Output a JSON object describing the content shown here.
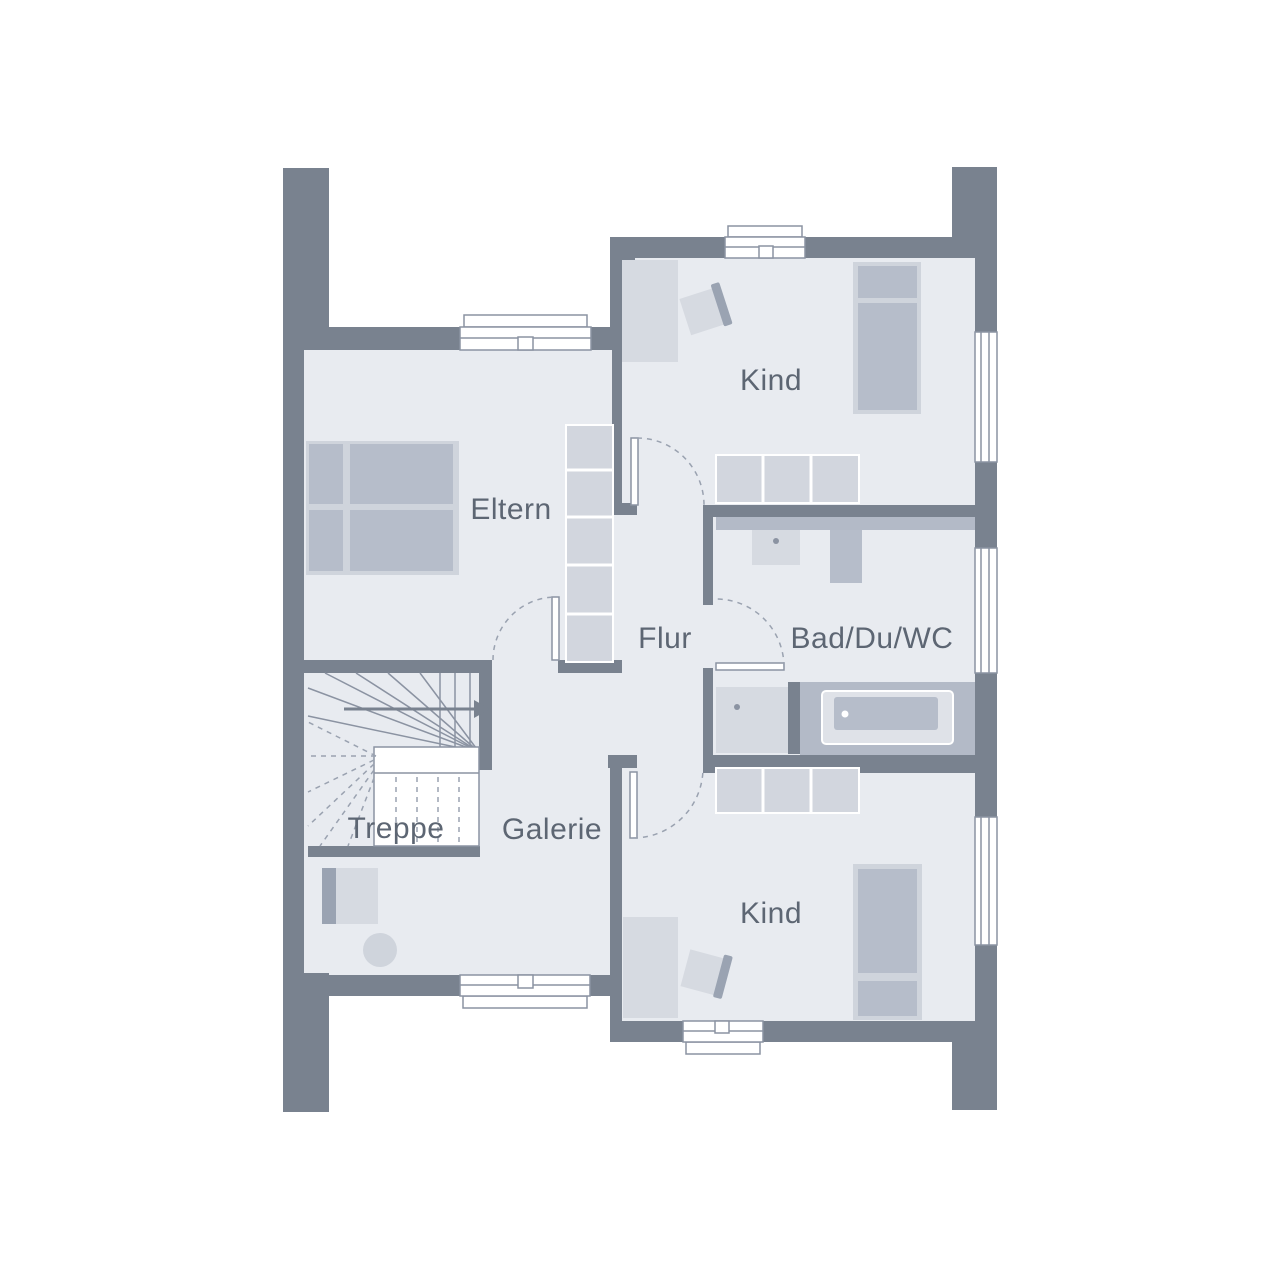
{
  "palette": {
    "wall": "#79828f",
    "floor": "#e8ebf0",
    "furniture_light": "#d6dae1",
    "furniture_medium": "#b6bdca",
    "furniture_frame": "#cfd4dc",
    "wardrobe": "#d2d6de",
    "fixture": "#b3bac7",
    "accent": "#9aa3b2",
    "line": "#8b93a2",
    "dashed_line": "#9aa2b0",
    "label_text": "#5d6673",
    "background": "#ffffff"
  },
  "rooms": {
    "kind_top": {
      "label": "Kind"
    },
    "eltern": {
      "label": "Eltern"
    },
    "flur": {
      "label": "Flur"
    },
    "bad": {
      "label": "Bad/Du/WC"
    },
    "treppe": {
      "label": "Treppe"
    },
    "galerie": {
      "label": "Galerie"
    },
    "kind_bottom": {
      "label": "Kind"
    }
  }
}
